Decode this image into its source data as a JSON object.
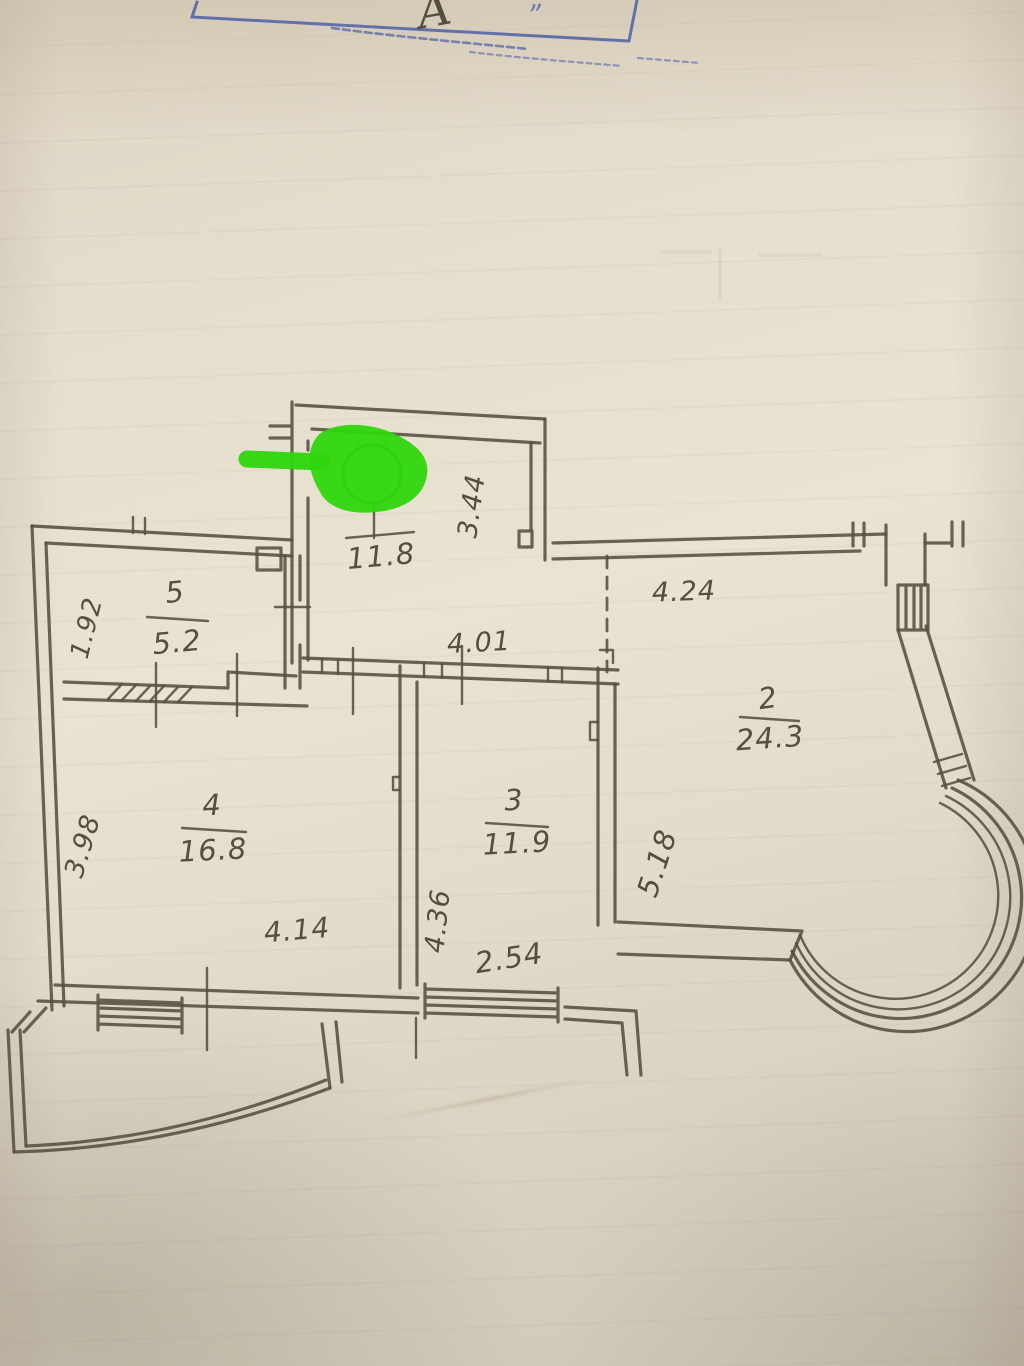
{
  "colors": {
    "ink": "#564e41",
    "stamp_blue": "#4c60a8",
    "paper": "#e3dccb"
  },
  "annotation": {
    "type": "green-marker-arrow-and-blob",
    "color": "#2ed60d"
  },
  "stamp": {
    "handwritten_letter": "А",
    "quote_mark": "”"
  },
  "plan": {
    "hall": {
      "area": "11.8"
    },
    "rooms": [
      {
        "number": "5",
        "area": "5.2"
      },
      {
        "number": "4",
        "area": "16.8"
      },
      {
        "number": "3",
        "area": "11.9"
      },
      {
        "number": "2",
        "area": "24.3"
      }
    ],
    "dimensions": {
      "hall_height": "3.44",
      "room2_top": "4.24",
      "room2_left": "5.18",
      "room3_top": "4.01",
      "room3_left": "4.36",
      "room3_bottom": "2.54",
      "room4_left": "3.98",
      "room4_bottom": "4.14",
      "room5_left": "1.92"
    }
  }
}
